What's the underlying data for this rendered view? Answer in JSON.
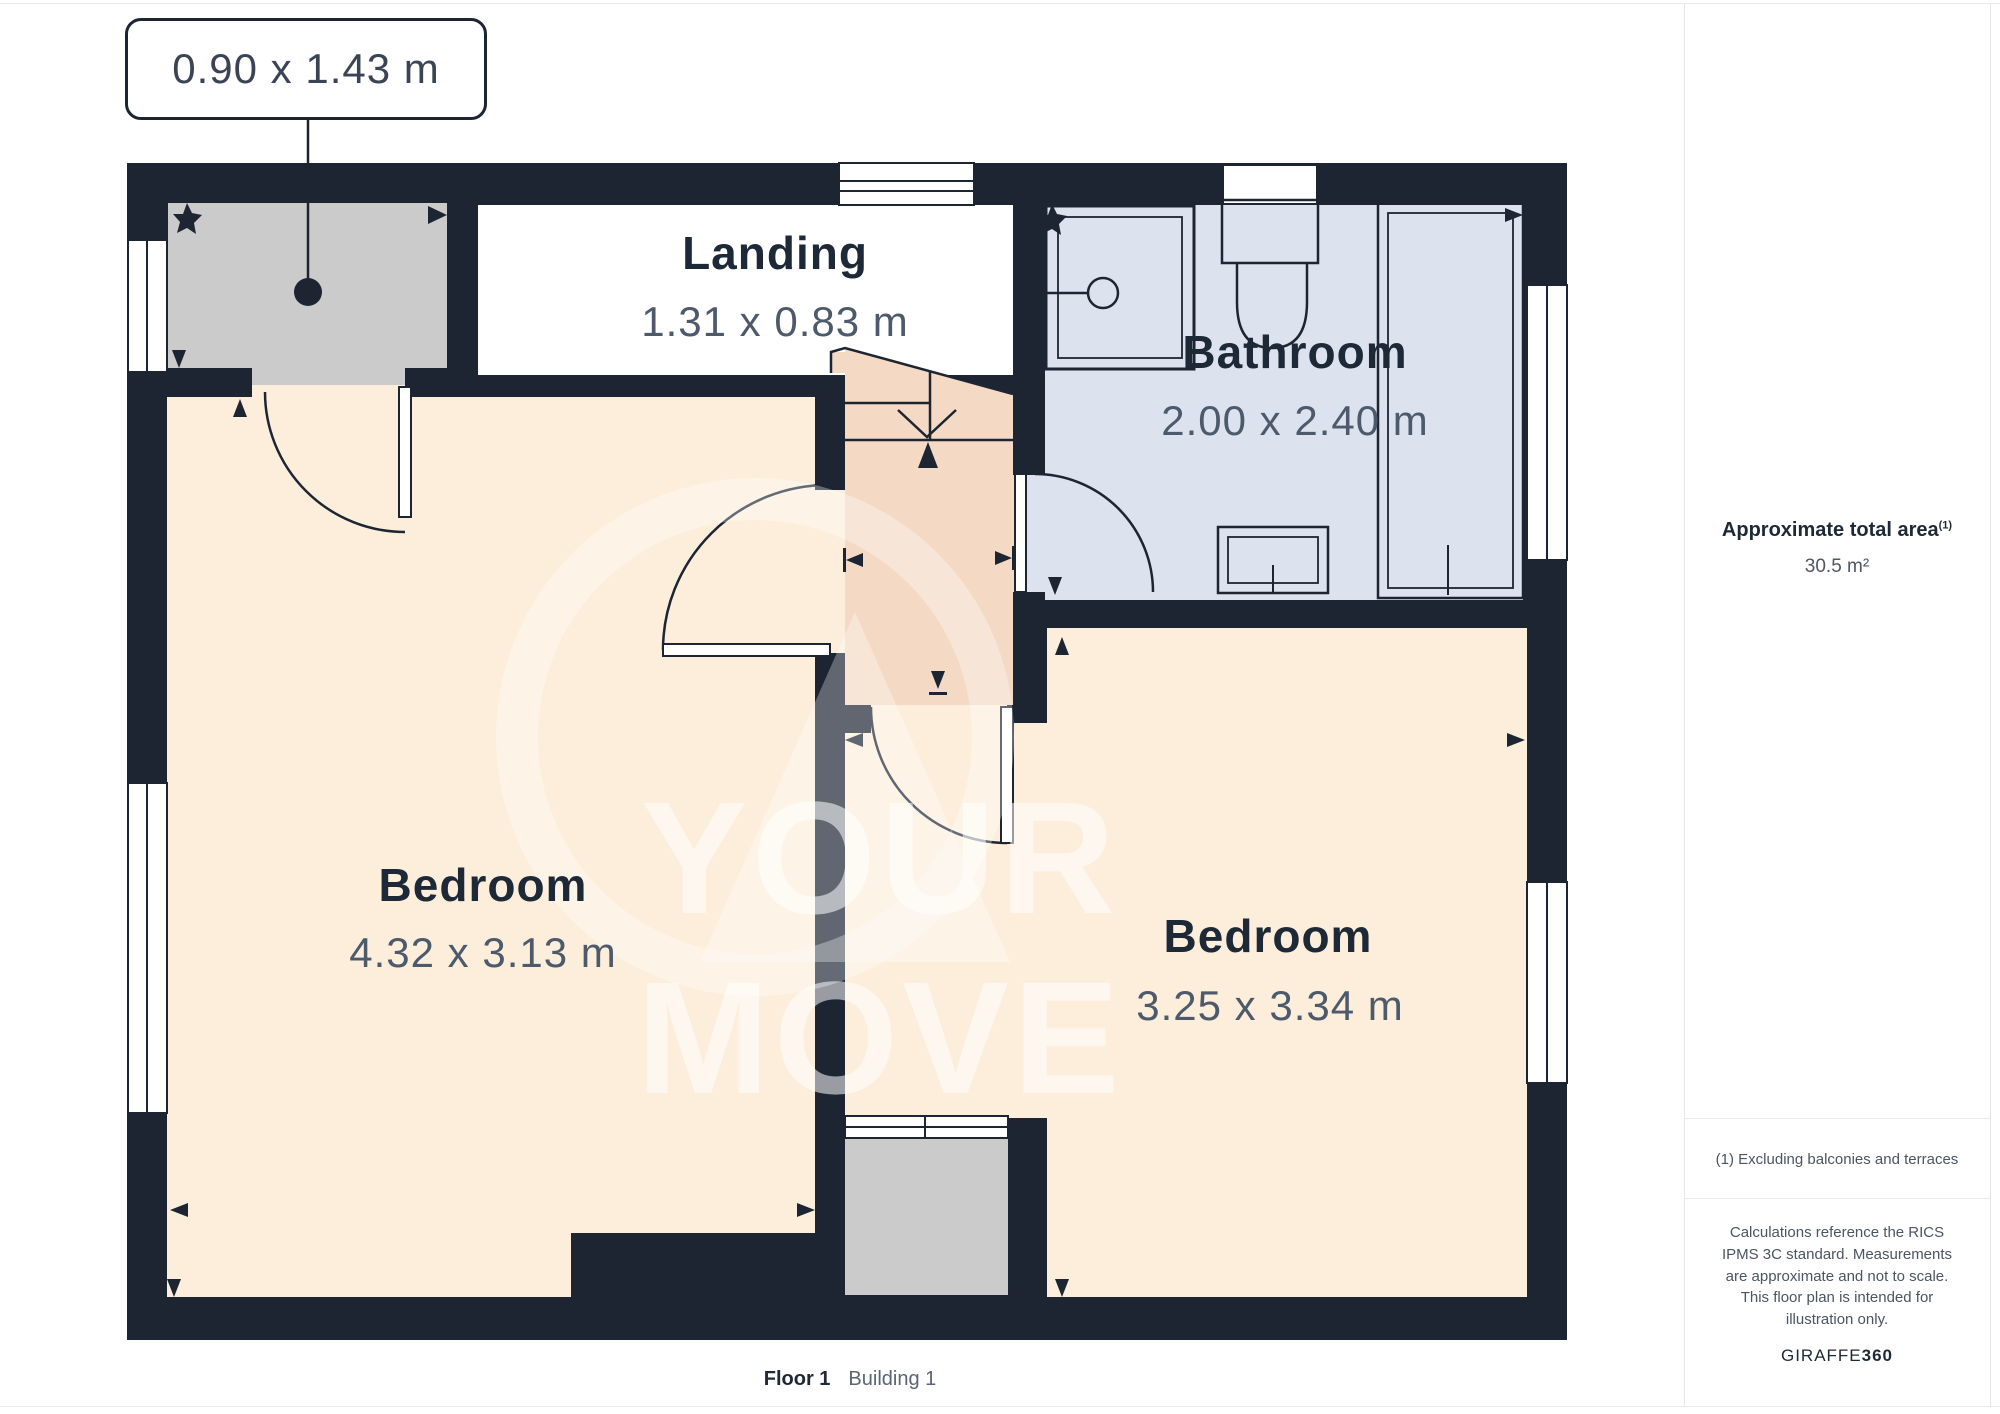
{
  "callout": {
    "text": "0.90 x 1.43 m"
  },
  "rooms": {
    "landing": {
      "name": "Landing",
      "dims": "1.31 x 0.83 m"
    },
    "bathroom": {
      "name": "Bathroom",
      "dims": "2.00 x 2.40 m"
    },
    "bedroom_left": {
      "name": "Bedroom",
      "dims": "4.32 x 3.13 m"
    },
    "bedroom_right": {
      "name": "Bedroom",
      "dims": "3.25 x 3.34 m"
    }
  },
  "sidebar": {
    "total_area_label": "Approximate total area",
    "total_area_superscript": "(1)",
    "total_area_value": "30.5 m²",
    "footnote": "(1) Excluding balconies and terraces",
    "disclaimer": "Calculations reference the RICS IPMS 3C standard. Measurements are approximate and not to scale. This floor plan is intended for illustration only.",
    "brand_name": "GIRAFFE",
    "brand_suffix": "360"
  },
  "caption": {
    "floor": "Floor 1",
    "building": "Building 1"
  },
  "watermark": {
    "text": "YOUR MOVE"
  },
  "colors": {
    "wall": "#1d2533",
    "bedroom_fill": "#fdeedc",
    "hall_fill": "#f4dac4",
    "bathroom_fill": "#dce2ee",
    "storage_fill": "#cbcbcb",
    "label_text": "#1d2936",
    "dim_text": "#4d5a6b"
  }
}
